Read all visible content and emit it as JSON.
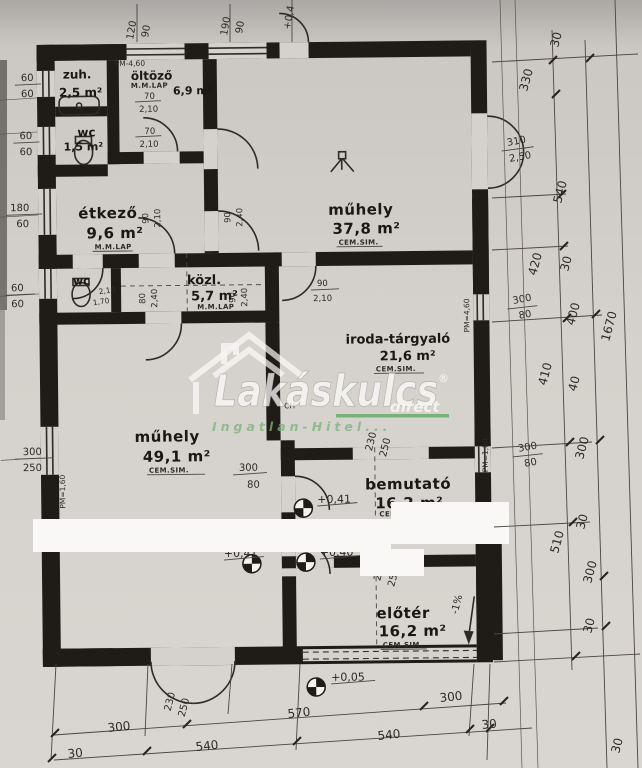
{
  "watermark": {
    "brand": "Lakáskulcs",
    "reg": "®",
    "direct": "direct",
    "tagline": "Ingatlan-Hitel...",
    "accent": "#4ea551"
  },
  "rooms": {
    "zuh": {
      "name": "zuh.",
      "area": "2,5 m²"
    },
    "oltozo": {
      "name": "öltöző",
      "area": "6,9 m²",
      "floor": "M.M.LAP"
    },
    "wc1": {
      "name": "wc",
      "area": "1,5 m²"
    },
    "etkezo": {
      "name": "étkező",
      "area": "9,6 m²",
      "floor": "M.M.LAP"
    },
    "muhely1": {
      "name": "műhely",
      "area": "37,8 m²",
      "floor": "CEM.SIM."
    },
    "wc2": {
      "name": "wc"
    },
    "kozl": {
      "name": "közl.",
      "area": "5,7 m²",
      "floor": "M.M.LAP"
    },
    "iroda": {
      "name": "iroda-tárgyaló",
      "area": "21,6 m²",
      "floor": "CEM.SIM."
    },
    "muhely2": {
      "name": "műhely",
      "area": "49,1 m²",
      "floor": "CEM.SIM."
    },
    "bemutato": {
      "name": "bemutató",
      "area": "16,2 m²",
      "floor": "CEM.SIM."
    },
    "eloter": {
      "name": "előtér",
      "area": "16,2 m²",
      "floor": "CEM.SIM."
    }
  },
  "levels": {
    "a": "+0,41",
    "b": "+0,41",
    "c": "+0,40",
    "d": "+0,05",
    "slope": "-1%"
  },
  "doors": {
    "d70a": {
      "w": "70",
      "h": "2,10"
    },
    "d70b": {
      "w": "70",
      "h": "2,10"
    },
    "d90a": {
      "w": "90",
      "h": "2,10"
    },
    "d90b": {
      "w": "90",
      "h": "2,40"
    },
    "d80": {
      "w": "80",
      "h": "2,40"
    },
    "d90c": {
      "w": "90",
      "h": "2,40"
    },
    "d90d": {
      "w": "90",
      "h": "2,10"
    },
    "d310": {
      "w": "310",
      "h": "2,50"
    },
    "d230a": {
      "w": "230",
      "h": "250"
    },
    "d230b": {
      "w": "230",
      "h": "250"
    },
    "d230c": {
      "w": "230",
      "h": "250"
    },
    "wc2door": {
      "w": "1,70",
      "h": "2,10"
    }
  },
  "windows": {
    "w300a": {
      "w": "300",
      "h": "80"
    },
    "w300b": {
      "w": "300",
      "h": "80"
    },
    "w300c": {
      "w": "300",
      "h": "80"
    },
    "left1": {
      "w": "60",
      "h": "60"
    },
    "left2": {
      "w": "60",
      "h": "60"
    },
    "left3": {
      "w": "180",
      "h": "60"
    },
    "left4": {
      "w": "60",
      "h": "60"
    },
    "left5": {
      "w": "300",
      "h": "250"
    }
  },
  "parapets": {
    "p1": "PM-4,60",
    "p2": "PM=4,60",
    "p3": "PM=1,80",
    "p4": "PM=1,60"
  },
  "marks": {
    "ch": "CH",
    "plus04": "+0,4"
  },
  "dims": {
    "top": {
      "a1": "120",
      "a2": "90",
      "b1": "190",
      "b2": "90"
    },
    "right": {
      "r30a": "30",
      "r330": "330",
      "r540a": "540",
      "r420": "420",
      "r30b": "30",
      "r400": "400",
      "r1670": "1670",
      "r410": "410",
      "r40": "40",
      "r300a": "300",
      "r510": "510",
      "r30c": "30",
      "r300b": "300",
      "r30d": "30",
      "r30e": "30"
    },
    "bottom": {
      "b300a": "300",
      "b570": "570",
      "b300b": "300",
      "b30a": "30",
      "b540a": "540",
      "b540b": "540",
      "b30b": "30"
    }
  }
}
